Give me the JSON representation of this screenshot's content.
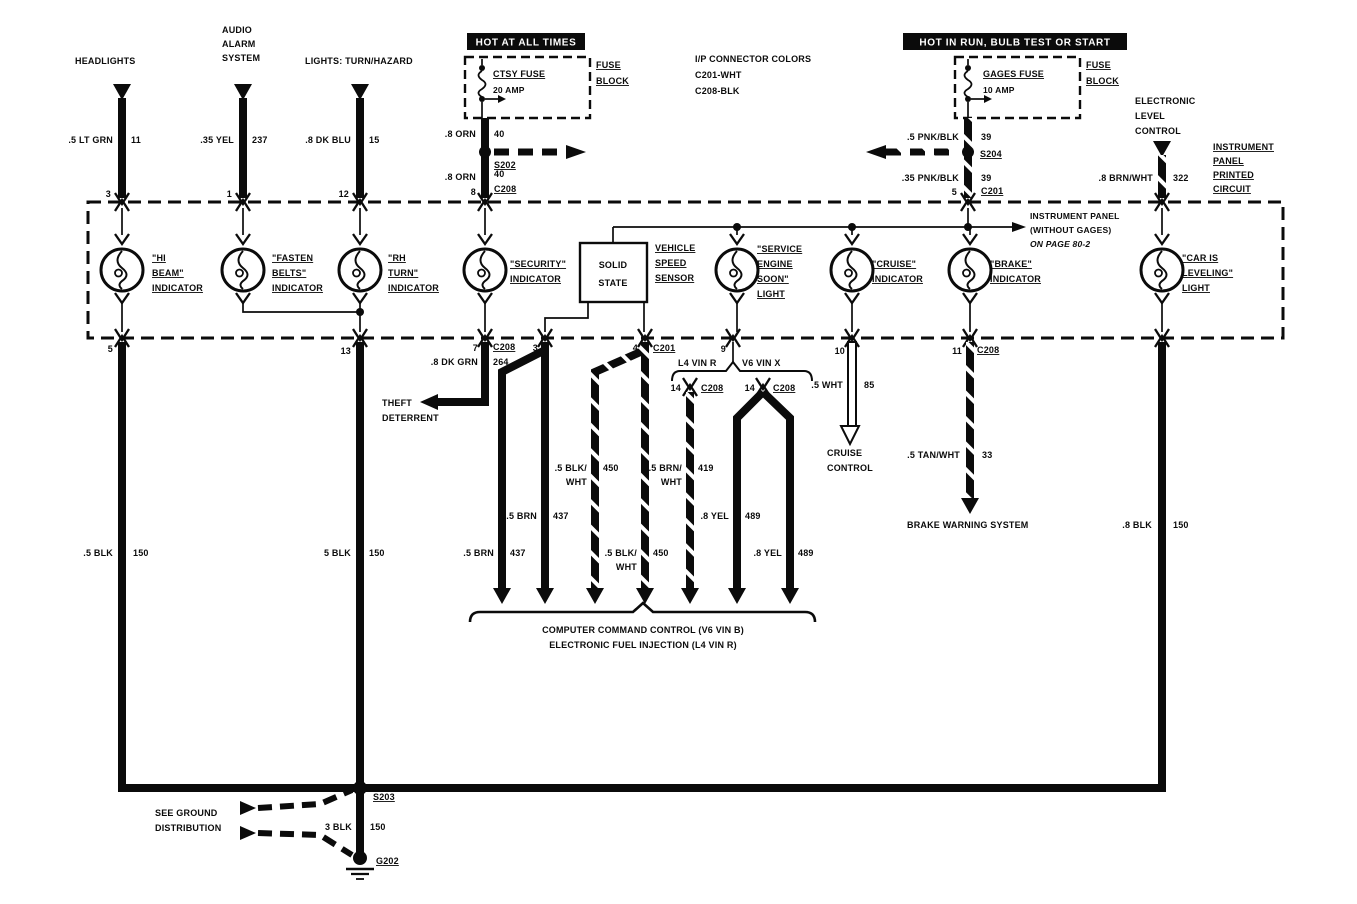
{
  "banners": {
    "hot_all_times": "HOT AT ALL TIMES",
    "hot_in_run": "HOT IN RUN,  BULB TEST OR START"
  },
  "feeds": {
    "headlights": {
      "name": "HEADLIGHTS",
      "wire": ".5 LT GRN",
      "circuit": "11",
      "pin": "3"
    },
    "audio_alarm": {
      "line1": "AUDIO",
      "line2": "ALARM",
      "line3": "SYSTEM",
      "wire": ".35 YEL",
      "circuit": "237",
      "pin": "1"
    },
    "turn_hazard": {
      "name": "LIGHTS: TURN/HAZARD",
      "wire": ".8 DK BLU",
      "circuit": "15",
      "pin": "12"
    },
    "elc": {
      "line1": "ELECTRONIC",
      "line2": "LEVEL",
      "line3": "CONTROL",
      "wire": ".8 BRN/WHT",
      "circuit": "322"
    }
  },
  "ctsy": {
    "fuse": "CTSY FUSE",
    "amps": "20 AMP",
    "block_line1": "FUSE",
    "block_line2": "BLOCK",
    "wire_upper": ".8 ORN",
    "circuit_upper": "40",
    "splice": "S202",
    "wire_lower": ".8 ORN",
    "circuit_lower": "40",
    "connector": "C208",
    "pin": "8"
  },
  "gages": {
    "fuse": "GAGES FUSE",
    "amps": "10 AMP",
    "block_line1": "FUSE",
    "block_line2": "BLOCK",
    "wire_upper": ".5 PNK/BLK",
    "circuit_upper": "39",
    "splice": "S204",
    "wire_lower": ".35 PNK/BLK",
    "circuit_lower": "39",
    "connector": "C201",
    "pin": "5"
  },
  "ip_connector_colors": {
    "title": "I/P CONNECTOR COLORS",
    "c201": "C201-WHT",
    "c208": "C208-BLK"
  },
  "printed_circuit": {
    "line1": "INSTRUMENT",
    "line2": "PANEL",
    "line3": "PRINTED",
    "line4": "CIRCUIT"
  },
  "without_gages_note": {
    "line1": "INSTRUMENT PANEL",
    "line2": "(WITHOUT GAGES)",
    "line3": "ON PAGE 80-2"
  },
  "indicators": {
    "hi_beam": {
      "line1": "\"HI",
      "line2": "BEAM\"",
      "line3": "INDICATOR"
    },
    "fasten_belts": {
      "line1": "\"FASTEN",
      "line2": "BELTS\"",
      "line3": "INDICATOR"
    },
    "rh_turn": {
      "line1": "\"RH",
      "line2": "TURN\"",
      "line3": "INDICATOR"
    },
    "security": {
      "line1": "\"SECURITY\"",
      "line2": "INDICATOR"
    },
    "solid_state": {
      "line1": "SOLID",
      "line2": "STATE"
    },
    "vss": {
      "line1": "VEHICLE",
      "line2": "SPEED",
      "line3": "SENSOR"
    },
    "service_engine": {
      "line1": "\"SERVICE",
      "line2": "ENGINE",
      "line3": "SOON\"",
      "line4": "LIGHT"
    },
    "cruise": {
      "line1": "\"CRUISE\"",
      "line2": "INDICATOR"
    },
    "brake": {
      "line1": "\"BRAKE\"",
      "line2": "INDICATOR"
    },
    "car_leveling": {
      "line1": "\"CAR IS",
      "line2": "LEVELING\"",
      "line3": "LIGHT"
    }
  },
  "pins": {
    "hi_beam_out": "5",
    "turn_out": "13",
    "security_out": "7",
    "security_conn": "C208",
    "ss_left": "3",
    "ss_right": "4",
    "ss_right_conn": "C201",
    "ses_out": "9",
    "cruise_out": "10",
    "brake_out": "11",
    "brake_conn": "C208"
  },
  "theft": {
    "wire": ".8 DK GRN",
    "circuit": "264",
    "line1": "THEFT",
    "line2": "DETERRENT"
  },
  "ccc": {
    "l4_label": "L4 VIN R",
    "v6_label": "V6 VIN X",
    "l4_pin": "14",
    "l4_conn": "C208",
    "v6_pin": "14",
    "v6_conn": "C208",
    "w1": ".5 BRN",
    "c1": "437",
    "w2": ".5 BRN",
    "c2": "437",
    "w3a": ".5 BLK/",
    "w3b": "WHT",
    "c3": "450",
    "w4a": ".5 BLK/",
    "w4b": "WHT",
    "c4": "450",
    "w5a": ".5 BRN/",
    "w5b": "WHT",
    "c5": "419",
    "w6": ".8 YEL",
    "c6": "489",
    "w7": ".8 YEL",
    "c7": "489",
    "caption_line1": "COMPUTER COMMAND CONTROL (V6 VIN B)",
    "caption_line2": "ELECTRONIC FUEL INJECTION (L4 VIN R)"
  },
  "outputs": {
    "cruise_control": {
      "wire": ".5 WHT",
      "circuit": "85",
      "line1": "CRUISE",
      "line2": "CONTROL"
    },
    "brake_warning": {
      "wire": ".5 TAN/WHT",
      "circuit": "33",
      "label": "BRAKE WARNING SYSTEM"
    },
    "car_ground": {
      "wire": ".8 BLK",
      "circuit": "150"
    }
  },
  "ground": {
    "left_wire": ".5 BLK",
    "left_circuit": "150",
    "mid_wire": "5 BLK",
    "mid_circuit": "150",
    "splice": "S203",
    "splice_wire": "3 BLK",
    "splice_circuit": "150",
    "ground_id": "G202",
    "see_line1": "SEE GROUND",
    "see_line2": "DISTRIBUTION"
  }
}
